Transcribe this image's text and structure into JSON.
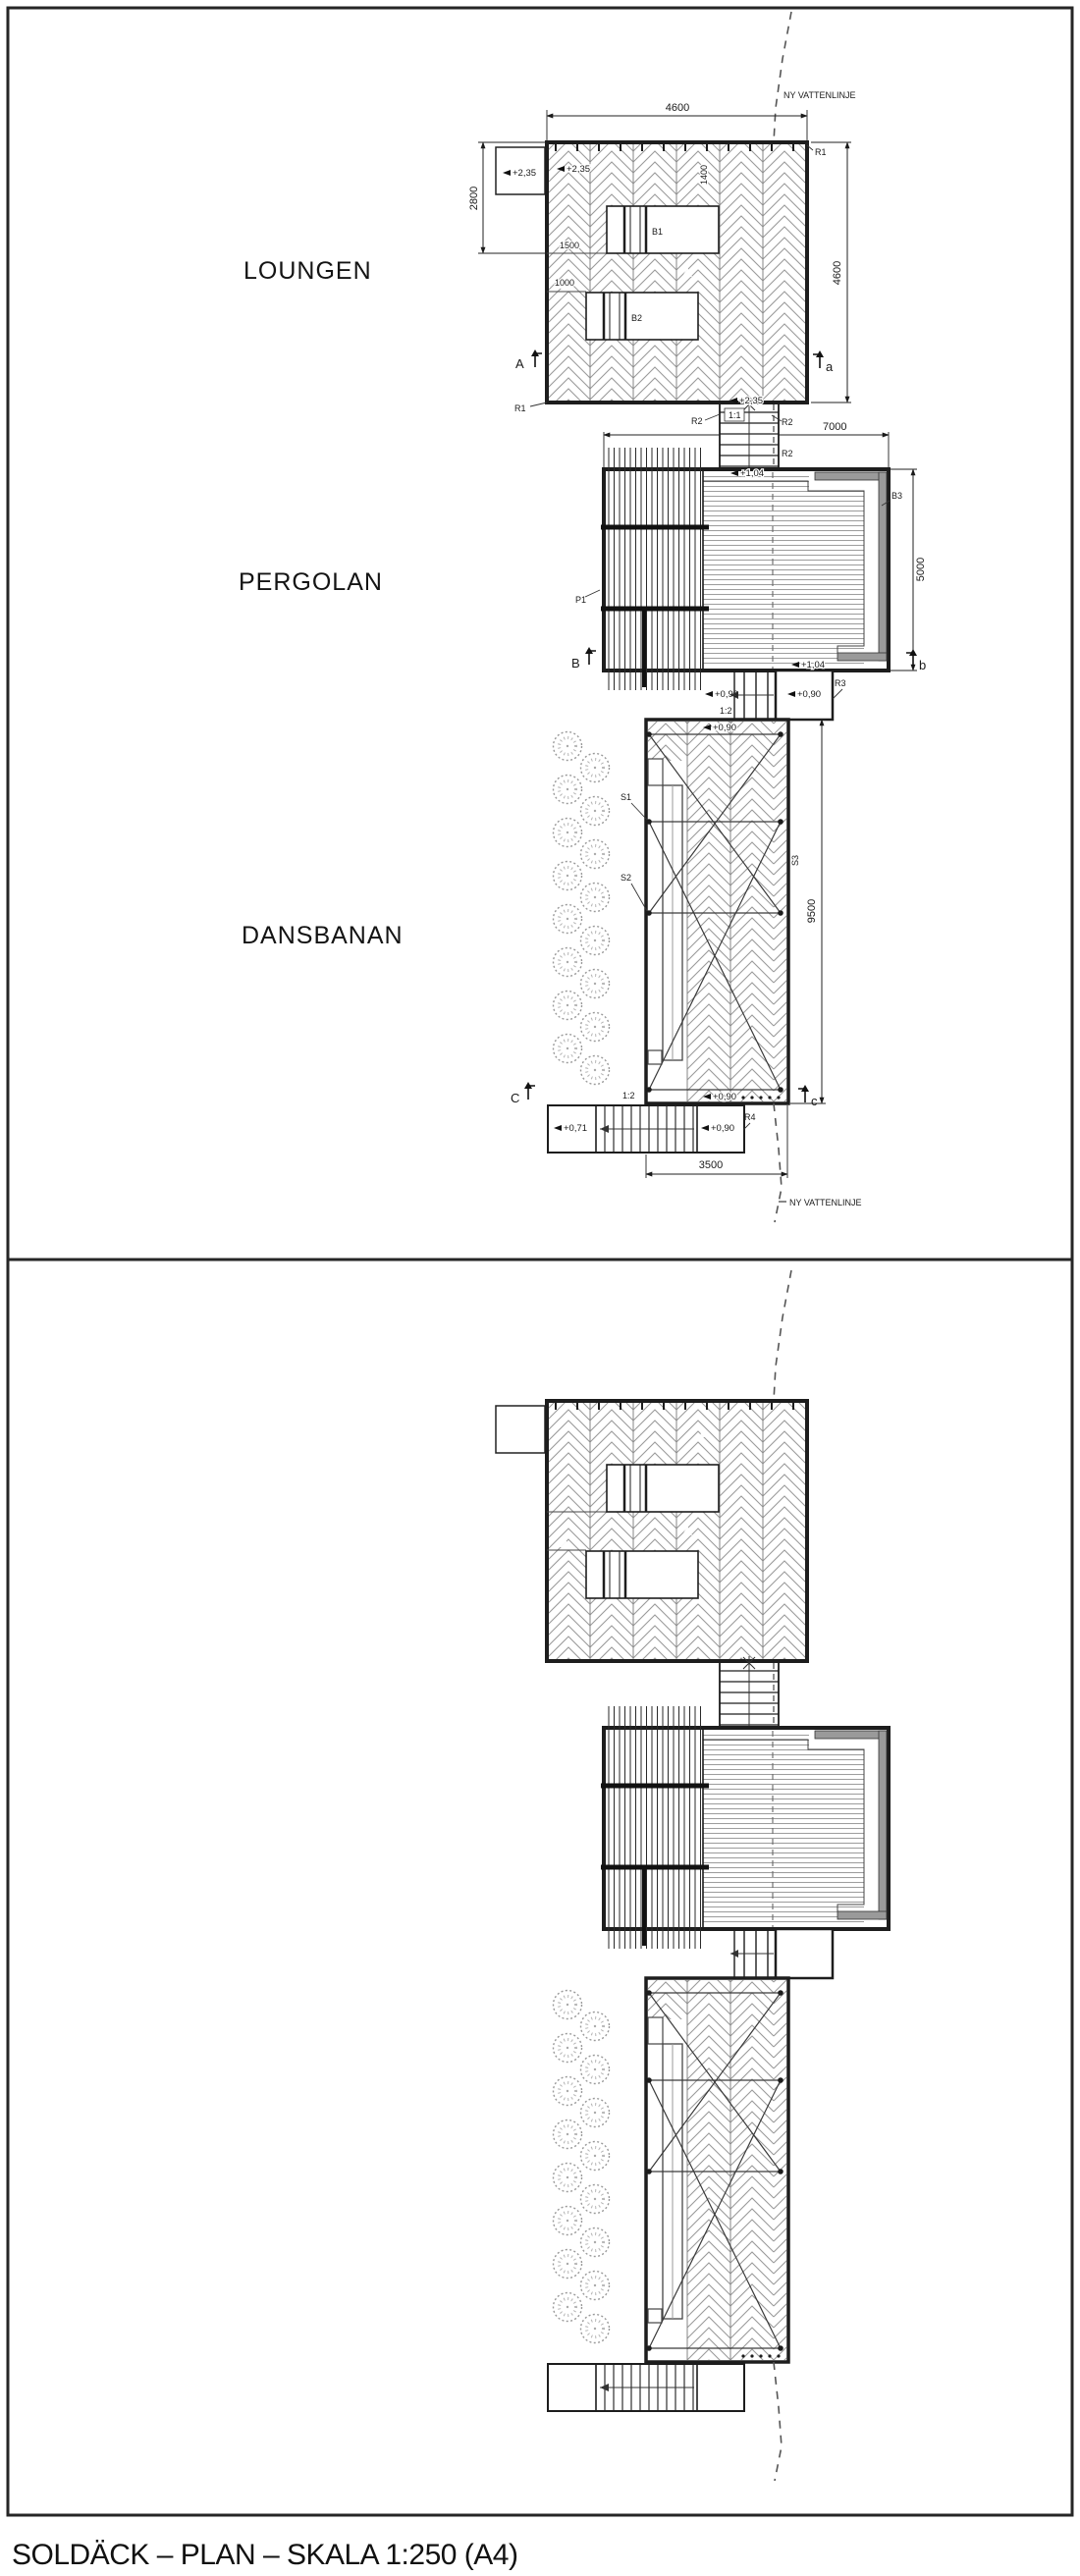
{
  "sheet": {
    "title": "SOLDÄCK – PLAN – SKALA 1:250 (A4)"
  },
  "areas": {
    "loungen": "LOUNGEN",
    "pergolan": "PERGOLAN",
    "dansbanan": "DANSBANAN"
  },
  "water": {
    "label_top": "NY VATTENLINJE",
    "label_bottom": "NY VATTENLINJE"
  },
  "dims": {
    "loungen_width": "4600",
    "loungen_depth": "4600",
    "loungen_left": "2800",
    "left_a": "1500",
    "left_b": "1000",
    "lounger": "1400",
    "pergolan_width": "7000",
    "pergolan_depth": "5000",
    "dansbanan_length": "9500",
    "stair_width": "3500"
  },
  "levels": {
    "entry": "+2,35",
    "loungen_deck": "+2,35",
    "stair_top": "+2,35",
    "pergolan_upper": "+1,04",
    "pergolan_lower": "+1,04",
    "landing_left": "+0,99",
    "landing_right": "+0,90",
    "dansbanan_top": "+0,90",
    "dansbanan_bottom": "+0,90",
    "lower_left": "+0,71",
    "lower_right": "+0,90"
  },
  "slopes": {
    "upper": "1:1",
    "middle": "1:2",
    "lower": "1:2"
  },
  "refs": {
    "r1_top": "R1",
    "r1_corner": "R1",
    "r2_left": "R2",
    "r2_right": "R2",
    "r2_lower": "R2",
    "r3": "R3",
    "r4": "R4",
    "b1": "B1",
    "b2": "B2",
    "b3": "B3",
    "p1": "P1",
    "s1": "S1",
    "s2": "S2",
    "s3": "S3"
  },
  "sections": {
    "a_cut": "A",
    "a_ref": "a",
    "b_cut": "B",
    "b_ref": "b",
    "c_cut": "C",
    "c_ref": "c"
  }
}
